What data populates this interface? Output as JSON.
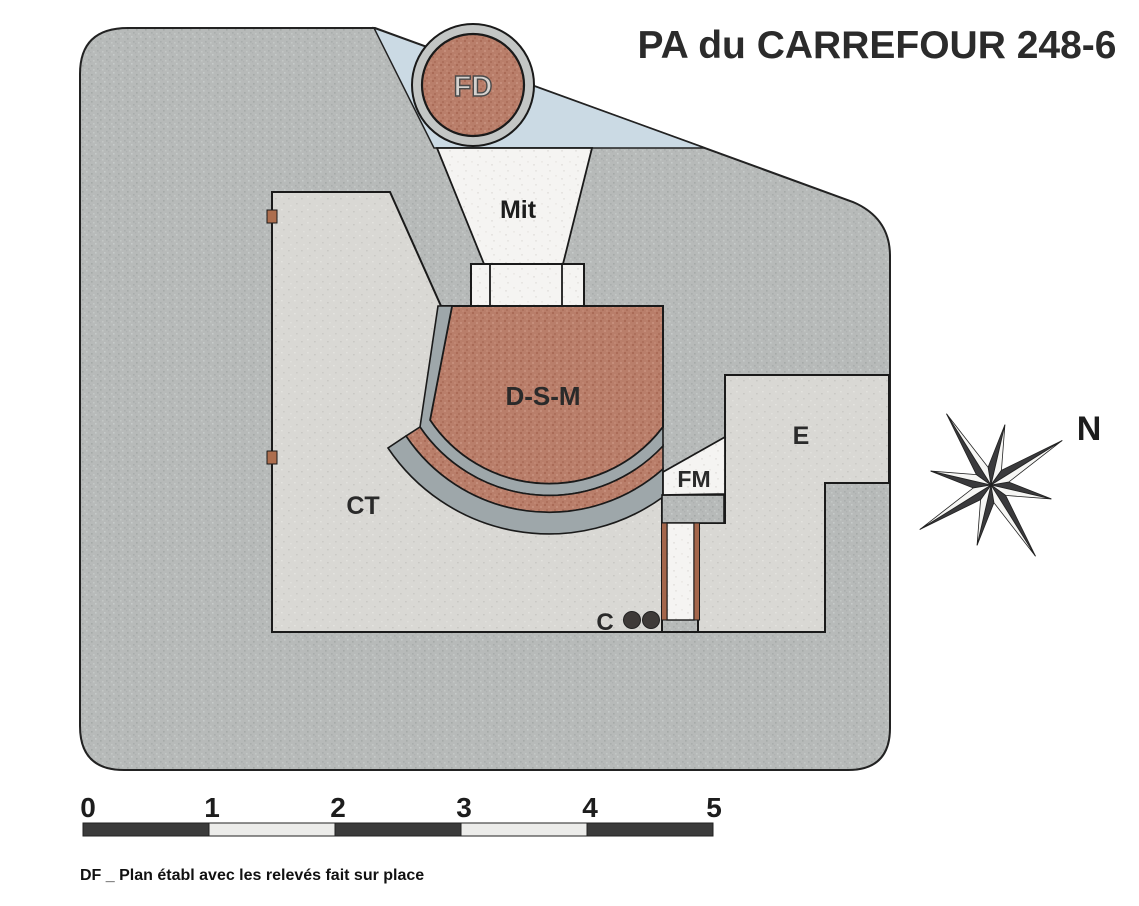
{
  "title": "PA du CARREFOUR 248-6",
  "plan": {
    "labels": {
      "fd": "FD",
      "mit": "Mit",
      "dsm": "D-S-M",
      "ct": "CT",
      "fm": "FM",
      "e": "E",
      "c": "C"
    }
  },
  "compass": {
    "north_label": "N"
  },
  "scalebar": {
    "ticks": [
      "0",
      "1",
      "2",
      "3",
      "4",
      "5"
    ]
  },
  "caption": "DF _ Plan établ avec les relevés fait sur place",
  "colors": {
    "body_gray": "#b7bab9",
    "room_concrete": "#d9d8d4",
    "emplacement_brown": "#b97e6a",
    "band_gray": "#9ea7aa",
    "glacis_blue": "#cbdae4",
    "wood_brown": "#a4664b",
    "embrasure_white": "#f5f4f2",
    "dot_dark": "#3e3a38",
    "ink": "#1a1a1a"
  }
}
